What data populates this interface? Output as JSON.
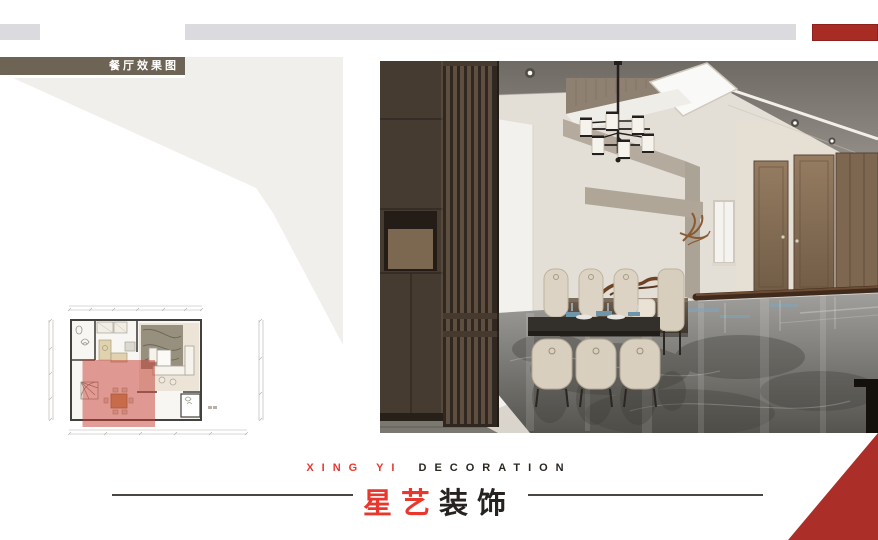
{
  "header": {
    "tag_label": "餐厅效果图"
  },
  "brand": {
    "english_red": "XING YI",
    "english_dark": "DECORATION",
    "cn_red": "星艺",
    "cn_dark": "装饰"
  },
  "colors": {
    "accent_red": "#a82b24",
    "brand_red": "#e8382e",
    "tag_olive": "#6e6455",
    "bar_gray": "#dbdadf",
    "wedge_gray": "#f1efeb",
    "plan_highlight": "rgba(198,60,50,0.5)"
  }
}
